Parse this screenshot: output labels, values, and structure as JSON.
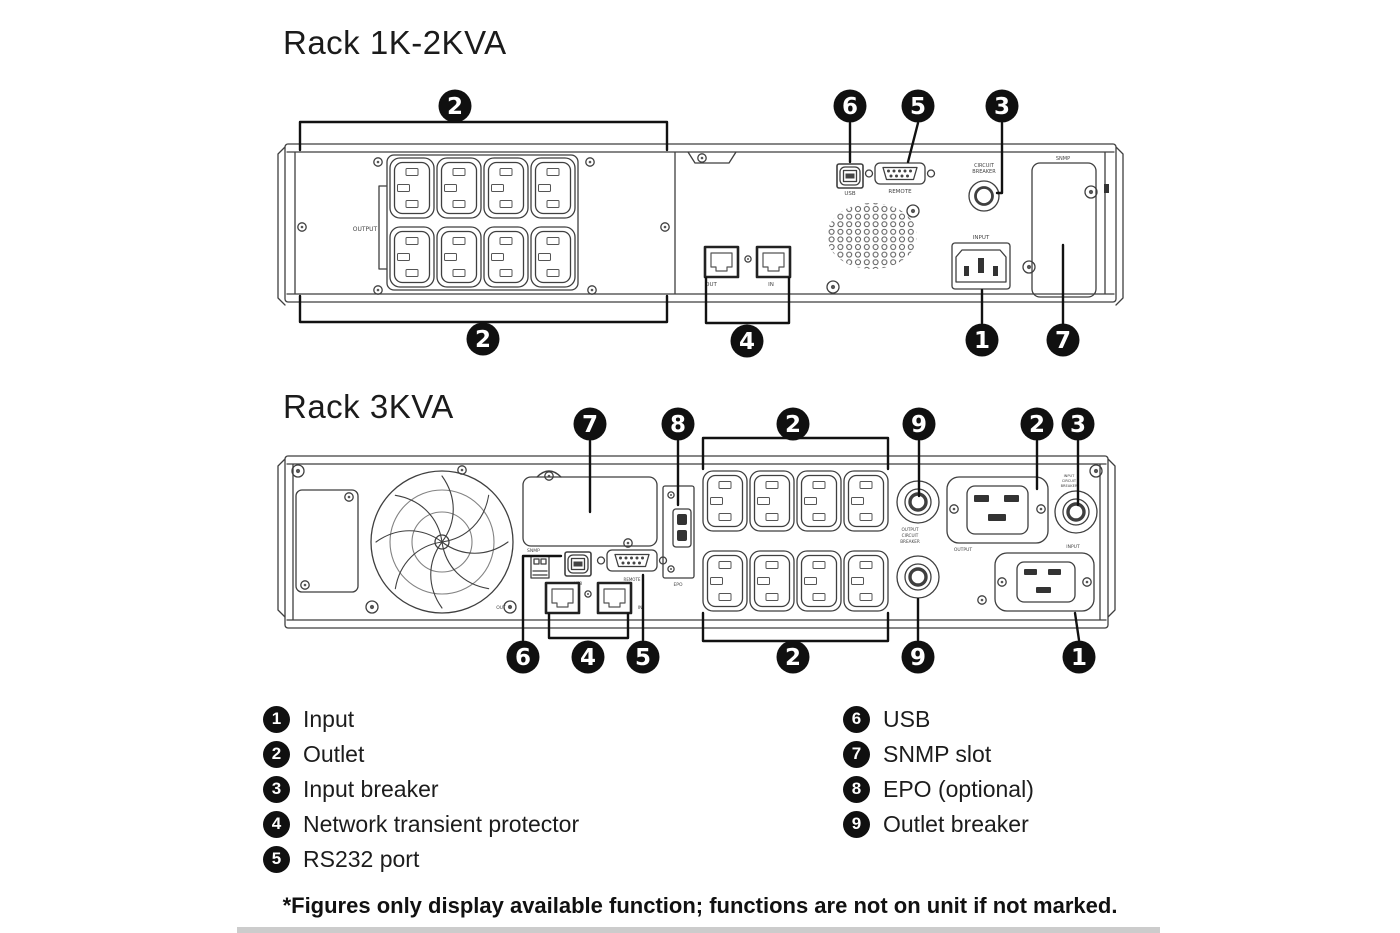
{
  "rack1": {
    "title": "Rack 1K-2KVA",
    "port_labels": {
      "output": "OUTPUT",
      "usb": "USB",
      "remote": "REMOTE",
      "circuit_breaker_line1": "CIRCUIT",
      "circuit_breaker_line2": "BREAKER",
      "input": "INPUT",
      "snmp": "SNMP",
      "out": "OUT",
      "in": "IN"
    },
    "callouts": {
      "outlet_top": "2",
      "usb": "6",
      "rs232": "5",
      "input_breaker": "3",
      "outlet_bottom": "2",
      "network_protector": "4",
      "input": "1",
      "snmp_slot": "7"
    }
  },
  "rack2": {
    "title": "Rack 3KVA",
    "port_labels": {
      "snmp": "SNMP",
      "epo": "EPO",
      "usb": "USB",
      "remote": "REMOTE",
      "out": "OUT",
      "in": "IN",
      "output": "OUTPUT",
      "input": "INPUT",
      "outlet_breaker_line1": "OUTPUT",
      "outlet_breaker_line2": "CIRCUIT",
      "outlet_breaker_line3": "BREAKER",
      "input_breaker_line1": "INPUT",
      "input_breaker_line2": "CIRCUIT",
      "input_breaker_line3": "BREAKER"
    },
    "callouts": {
      "snmp_slot": "7",
      "epo": "8",
      "outlet_top": "2",
      "outlet_breaker_top": "9",
      "output_c19": "2",
      "input_breaker": "3",
      "usb": "6",
      "network_protector": "4",
      "rs232": "5",
      "outlet_bottom": "2",
      "outlet_breaker_bottom": "9",
      "input": "1"
    }
  },
  "legend": {
    "items": [
      {
        "num": "1",
        "label": "Input"
      },
      {
        "num": "2",
        "label": "Outlet"
      },
      {
        "num": "3",
        "label": "Input breaker"
      },
      {
        "num": "4",
        "label": "Network transient protector"
      },
      {
        "num": "5",
        "label": "RS232 port"
      },
      {
        "num": "6",
        "label": "USB"
      },
      {
        "num": "7",
        "label": "SNMP slot"
      },
      {
        "num": "8",
        "label": "EPO (optional)"
      },
      {
        "num": "9",
        "label": "Outlet breaker"
      }
    ]
  },
  "footer": {
    "note": "*Figures only display available function; functions are not on unit if not marked."
  },
  "colors": {
    "line": "#3f3f3f",
    "callout": "#101010",
    "callout_text": "#ffffff",
    "background": "#ffffff"
  }
}
